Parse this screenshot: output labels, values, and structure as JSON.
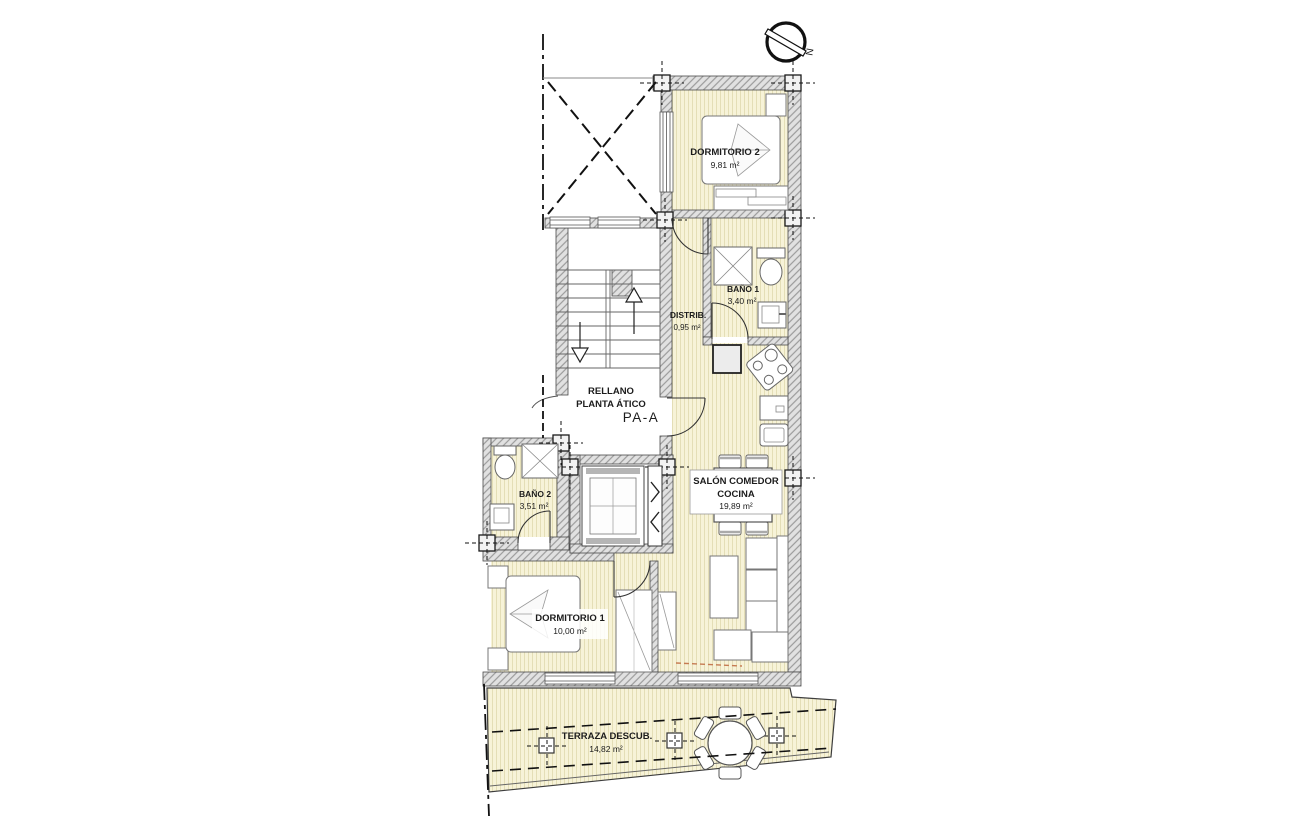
{
  "plan": {
    "unit_label": "PA-A",
    "accent_color": "#b05e68",
    "compass_letter": "N",
    "rooms": {
      "dormitorio2": {
        "name": "DORMITORIO 2",
        "area": "9,81 m²"
      },
      "bano1": {
        "name": "BAÑO 1",
        "area": "3,40 m²"
      },
      "distrib": {
        "name": "DISTRIB.",
        "area": "0,95 m²"
      },
      "rellano": {
        "line1": "RELLANO",
        "line2": "PLANTA ÁTICO"
      },
      "bano2": {
        "name": "BAÑO 2",
        "area": "3,51 m²"
      },
      "salon": {
        "line1": "SALÓN COMEDOR",
        "line2": "COCINA",
        "area": "19,89 m²"
      },
      "dormitorio1": {
        "name": "DORMITORIO 1",
        "area": "10,00 m²"
      },
      "terraza": {
        "name": "TERRAZA DESCUB.",
        "area": "14,82 m²"
      }
    }
  }
}
